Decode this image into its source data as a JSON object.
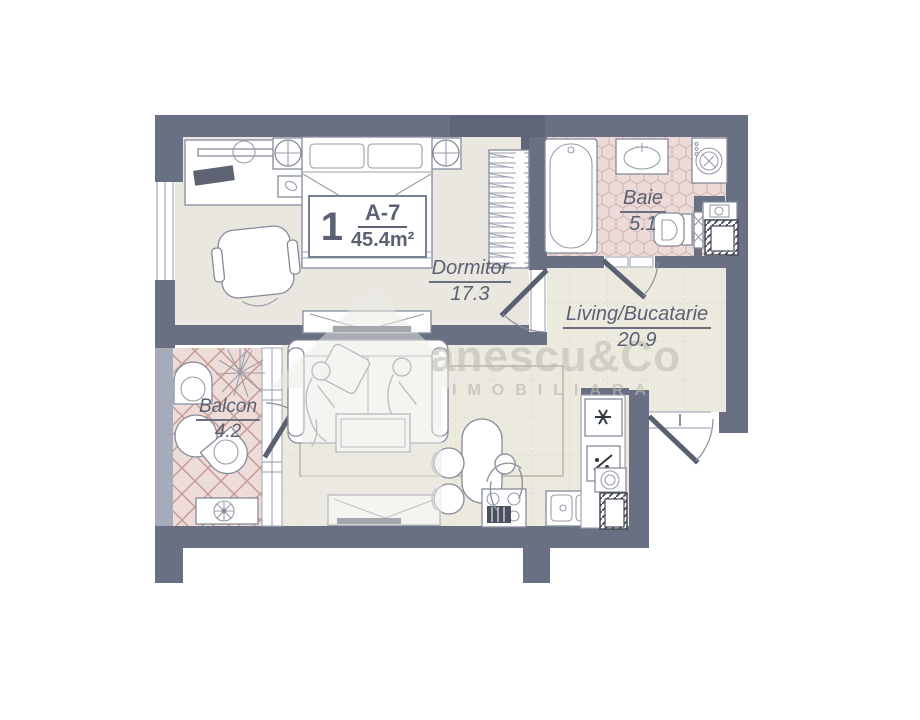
{
  "plan": {
    "unit": {
      "number": "1",
      "code": "A-7",
      "total_area": "45.4m²"
    },
    "rooms": [
      {
        "name": "Dormitor",
        "area": "17.3"
      },
      {
        "name": "Baie",
        "area": "5.1"
      },
      {
        "name": "Living/Bucatarie",
        "area": "20.9"
      },
      {
        "name": "Balcon",
        "area": "4.2"
      }
    ],
    "watermark": {
      "brand": "anescu&Co",
      "tagline": "IMOBILIARA"
    }
  },
  "colors": {
    "wall": "#6a7083",
    "wall_dark": "#5e6578",
    "wall_light": "#a6abba",
    "bedroom_floor": "#eae7e0",
    "living_floor": "#ece9df",
    "bath_floor": "#ebdad7",
    "balcony_floor": "#eedcd9",
    "text": "#5b6273"
  }
}
